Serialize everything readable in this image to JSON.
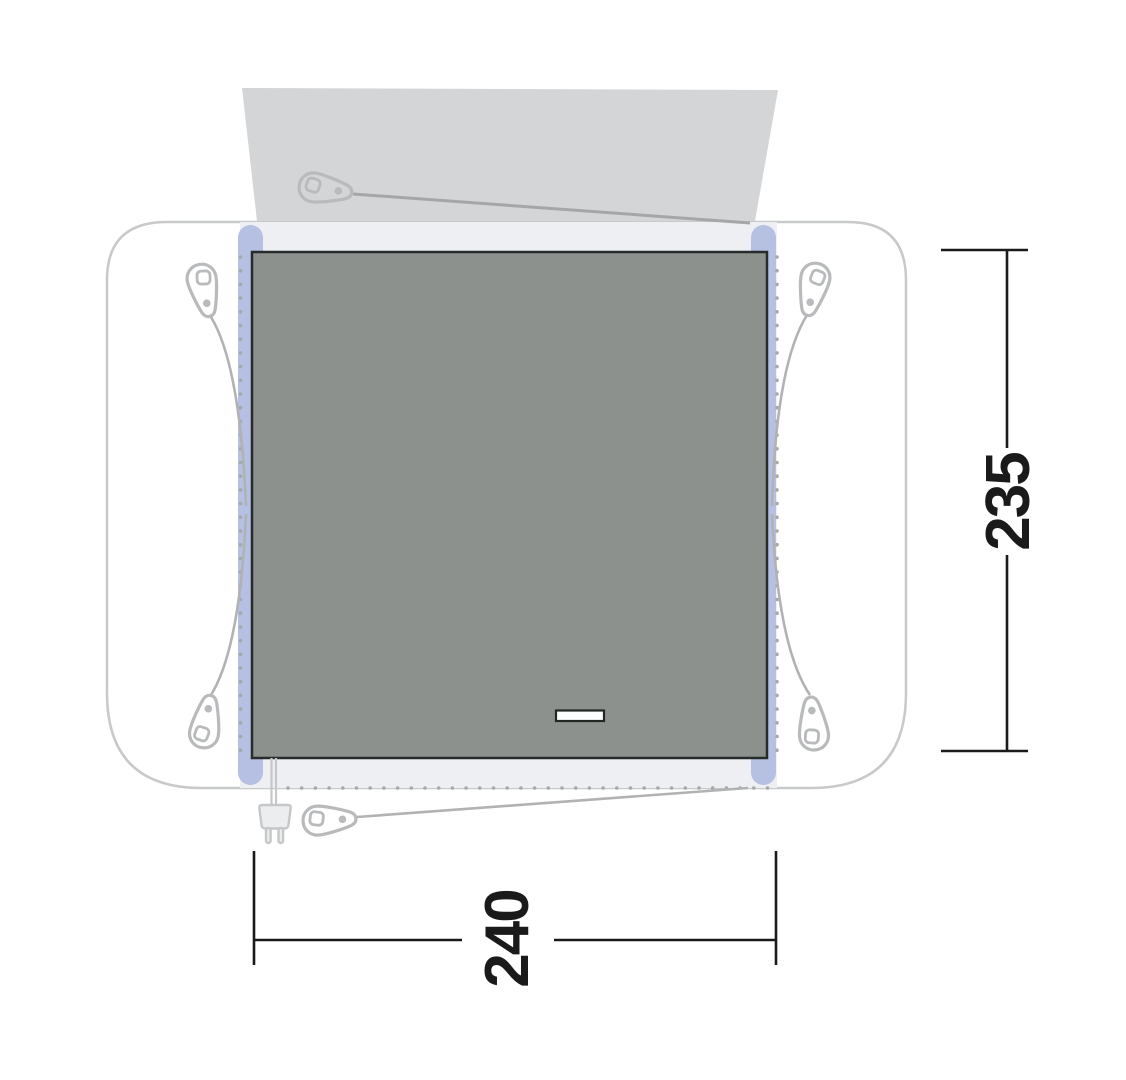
{
  "diagram": {
    "type": "awning-floorplan-top-view",
    "dimensions": {
      "height": {
        "value": "235"
      },
      "width": {
        "value": "240"
      }
    },
    "colors": {
      "floor_area": "#8c918e",
      "floor_border": "#272b2a",
      "canopy": "#d3d5d7",
      "groundsheet": "#edeff2",
      "corner_rail": "#b5c0e2",
      "outline": "#c7c9cb",
      "guyline": "#b0b2b4",
      "dimension": "#1a1a1a"
    },
    "icons": {
      "pegs": [
        "peg-icon-canopy",
        "peg-icon-left-top",
        "peg-icon-left-bottom",
        "peg-icon-right-top",
        "peg-icon-right-bottom",
        "peg-icon-bottom"
      ],
      "plug": "power-plug-icon",
      "door": "door-vent-marker"
    }
  }
}
